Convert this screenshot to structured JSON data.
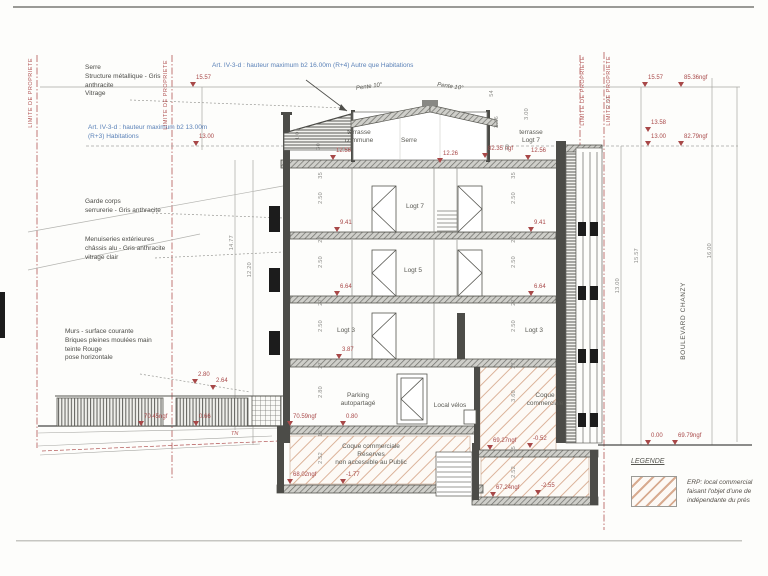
{
  "drawing_type": "coupe transversale / building cross-section",
  "colors": {
    "property_limit_red": "#b25555",
    "marker_red": "#a84848",
    "regulation_blue": "#5b82b8",
    "line_gray": "#9a9a96",
    "wall_dark": "#4c4c48",
    "erp_hatch": "#d8ab90"
  },
  "regulation_notes": [
    {
      "label": "Art. IV-3-d : hauteur maximum b2 16.00m (R+4) Autre que Habitations",
      "x": 212,
      "y": 62
    },
    {
      "label": "Art. IV-3-d : hauteur maximum b2 13.00m\n(R+3) Habitations",
      "x": 88,
      "y": 124
    }
  ],
  "material_notes": [
    {
      "label": "Serre\nStructure métallique - Gris\nanthracite\nVitrage",
      "x": 85,
      "y": 64
    },
    {
      "label": "Garde corps\nserrurerie - Gris anthracite",
      "x": 85,
      "y": 198
    },
    {
      "label": "Menuiseries extérieures\nchâssis alu - Gris anthracite\nvitrage clair",
      "x": 85,
      "y": 236
    },
    {
      "label": "Murs - surface courante\nBriques pleines moulées main\nteinte Rouge\npose horizontale",
      "x": 65,
      "y": 328
    }
  ],
  "property_limits": [
    {
      "label": "LIMITE DE PROPRIETE",
      "x": 28,
      "y": 58
    },
    {
      "label": "LIMITE DE PROPRIETE",
      "x": 163,
      "y": 60
    },
    {
      "label": "LIMITE DE PROPRIETE",
      "x": 580,
      "y": 56
    },
    {
      "label": "LIMITE DE PROPRIETE",
      "x": 606,
      "y": 56
    }
  ],
  "slopes": [
    {
      "label": "Pente 10°",
      "x": 356,
      "y": 84,
      "rot": -8
    },
    {
      "label": "Pente 10°",
      "x": 437,
      "y": 84,
      "rot": 8
    }
  ],
  "rooms": [
    {
      "label": "terrasse\ncommune",
      "x": 334,
      "y": 129,
      "w": 50
    },
    {
      "label": "Serre",
      "x": 389,
      "y": 137,
      "w": 40
    },
    {
      "label": "terrasse\nLogt 7",
      "x": 509,
      "y": 129,
      "w": 44
    },
    {
      "label": "Logt 7",
      "x": 395,
      "y": 203,
      "w": 40
    },
    {
      "label": "Logt 5",
      "x": 393,
      "y": 267,
      "w": 40
    },
    {
      "label": "Logt 3",
      "x": 326,
      "y": 327,
      "w": 40
    },
    {
      "label": "Logt 3",
      "x": 514,
      "y": 327,
      "w": 40
    },
    {
      "label": "Parking\nautopartagé",
      "x": 326,
      "y": 392,
      "w": 64
    },
    {
      "label": "Local vélos",
      "x": 425,
      "y": 402,
      "w": 50
    },
    {
      "label": "Coque\ncommerciale",
      "x": 517,
      "y": 392,
      "w": 56
    },
    {
      "label": "Coque commerciale\nRéserves\nnon accessible au Public",
      "x": 311,
      "y": 443,
      "w": 120
    }
  ],
  "markers": [
    {
      "label": "15.57",
      "x": 190,
      "y": 75
    },
    {
      "label": "13.00",
      "x": 193,
      "y": 134
    },
    {
      "label": "12.56",
      "x": 330,
      "y": 148
    },
    {
      "label": "12.26",
      "x": 437,
      "y": 151
    },
    {
      "label": "82.35 ngf",
      "x": 482,
      "y": 146
    },
    {
      "label": "12.56",
      "x": 525,
      "y": 148
    },
    {
      "label": "9.41",
      "x": 334,
      "y": 220
    },
    {
      "label": "9.41",
      "x": 528,
      "y": 220
    },
    {
      "label": "6.64",
      "x": 334,
      "y": 284
    },
    {
      "label": "6.64",
      "x": 528,
      "y": 284
    },
    {
      "label": "3.87",
      "x": 336,
      "y": 347
    },
    {
      "label": "2.80",
      "x": 192,
      "y": 372
    },
    {
      "label": "2.64",
      "x": 210,
      "y": 378
    },
    {
      "label": "70.45ngf",
      "x": 138,
      "y": 414
    },
    {
      "label": "0.66",
      "x": 193,
      "y": 414
    },
    {
      "label": "70.59ngf",
      "x": 287,
      "y": 414
    },
    {
      "label": "0.80",
      "x": 340,
      "y": 414
    },
    {
      "label": "69.27ngf",
      "x": 487,
      "y": 438
    },
    {
      "label": "-0.52",
      "x": 527,
      "y": 436
    },
    {
      "label": "68.02ngf",
      "x": 287,
      "y": 472
    },
    {
      "label": "-1.77",
      "x": 340,
      "y": 472
    },
    {
      "label": "67.24ngf",
      "x": 490,
      "y": 485
    },
    {
      "label": "-2.55",
      "x": 535,
      "y": 483
    },
    {
      "label": "0.00",
      "x": 645,
      "y": 433
    },
    {
      "label": "69.79ngf",
      "x": 672,
      "y": 433
    },
    {
      "label": "15.57",
      "x": 642,
      "y": 75
    },
    {
      "label": "85.36ngf",
      "x": 678,
      "y": 75
    },
    {
      "label": "13.58",
      "x": 645,
      "y": 120
    },
    {
      "label": "13.00",
      "x": 645,
      "y": 134
    },
    {
      "label": "82.79ngf",
      "x": 678,
      "y": 134
    }
  ],
  "dims": [
    {
      "label": "14.77",
      "x": 229,
      "y": 235
    },
    {
      "label": "12.20",
      "x": 247,
      "y": 262
    },
    {
      "label": "1.01",
      "x": 295,
      "y": 128
    },
    {
      "label": "30",
      "x": 316,
      "y": 143
    },
    {
      "label": "35",
      "x": 318,
      "y": 172
    },
    {
      "label": "2.50",
      "x": 318,
      "y": 192
    },
    {
      "label": "27",
      "x": 318,
      "y": 236
    },
    {
      "label": "2.50",
      "x": 318,
      "y": 256
    },
    {
      "label": "27",
      "x": 318,
      "y": 299
    },
    {
      "label": "2.50",
      "x": 318,
      "y": 320
    },
    {
      "label": "27",
      "x": 318,
      "y": 362
    },
    {
      "label": "2.80",
      "x": 318,
      "y": 386
    },
    {
      "label": "12",
      "x": 318,
      "y": 430
    },
    {
      "label": "2.52",
      "x": 318,
      "y": 452
    },
    {
      "label": "54",
      "x": 489,
      "y": 90
    },
    {
      "label": "2.46",
      "x": 494,
      "y": 116
    },
    {
      "label": "3.00",
      "x": 524,
      "y": 108
    },
    {
      "label": "30",
      "x": 505,
      "y": 144
    },
    {
      "label": "35",
      "x": 511,
      "y": 172
    },
    {
      "label": "2.50",
      "x": 511,
      "y": 192
    },
    {
      "label": "27",
      "x": 511,
      "y": 236
    },
    {
      "label": "2.50",
      "x": 511,
      "y": 256
    },
    {
      "label": "27",
      "x": 511,
      "y": 299
    },
    {
      "label": "2.50",
      "x": 511,
      "y": 320
    },
    {
      "label": "27",
      "x": 511,
      "y": 362
    },
    {
      "label": "3.60",
      "x": 511,
      "y": 390
    },
    {
      "label": "35",
      "x": 511,
      "y": 446
    },
    {
      "label": "2.52",
      "x": 511,
      "y": 466
    },
    {
      "label": "2.57",
      "x": 606,
      "y": 96
    },
    {
      "label": "13.00",
      "x": 615,
      "y": 278
    },
    {
      "label": "15.57",
      "x": 634,
      "y": 248
    },
    {
      "label": "16.00",
      "x": 707,
      "y": 243
    }
  ],
  "street": {
    "label": "BOULEVARD CHANZY"
  },
  "tn": {
    "label": "TN"
  },
  "legend": {
    "title": "LEGENDE",
    "erp_text": "ERP: local commercial\nfaisant l'objet d'une de\nindépendante du prés"
  }
}
